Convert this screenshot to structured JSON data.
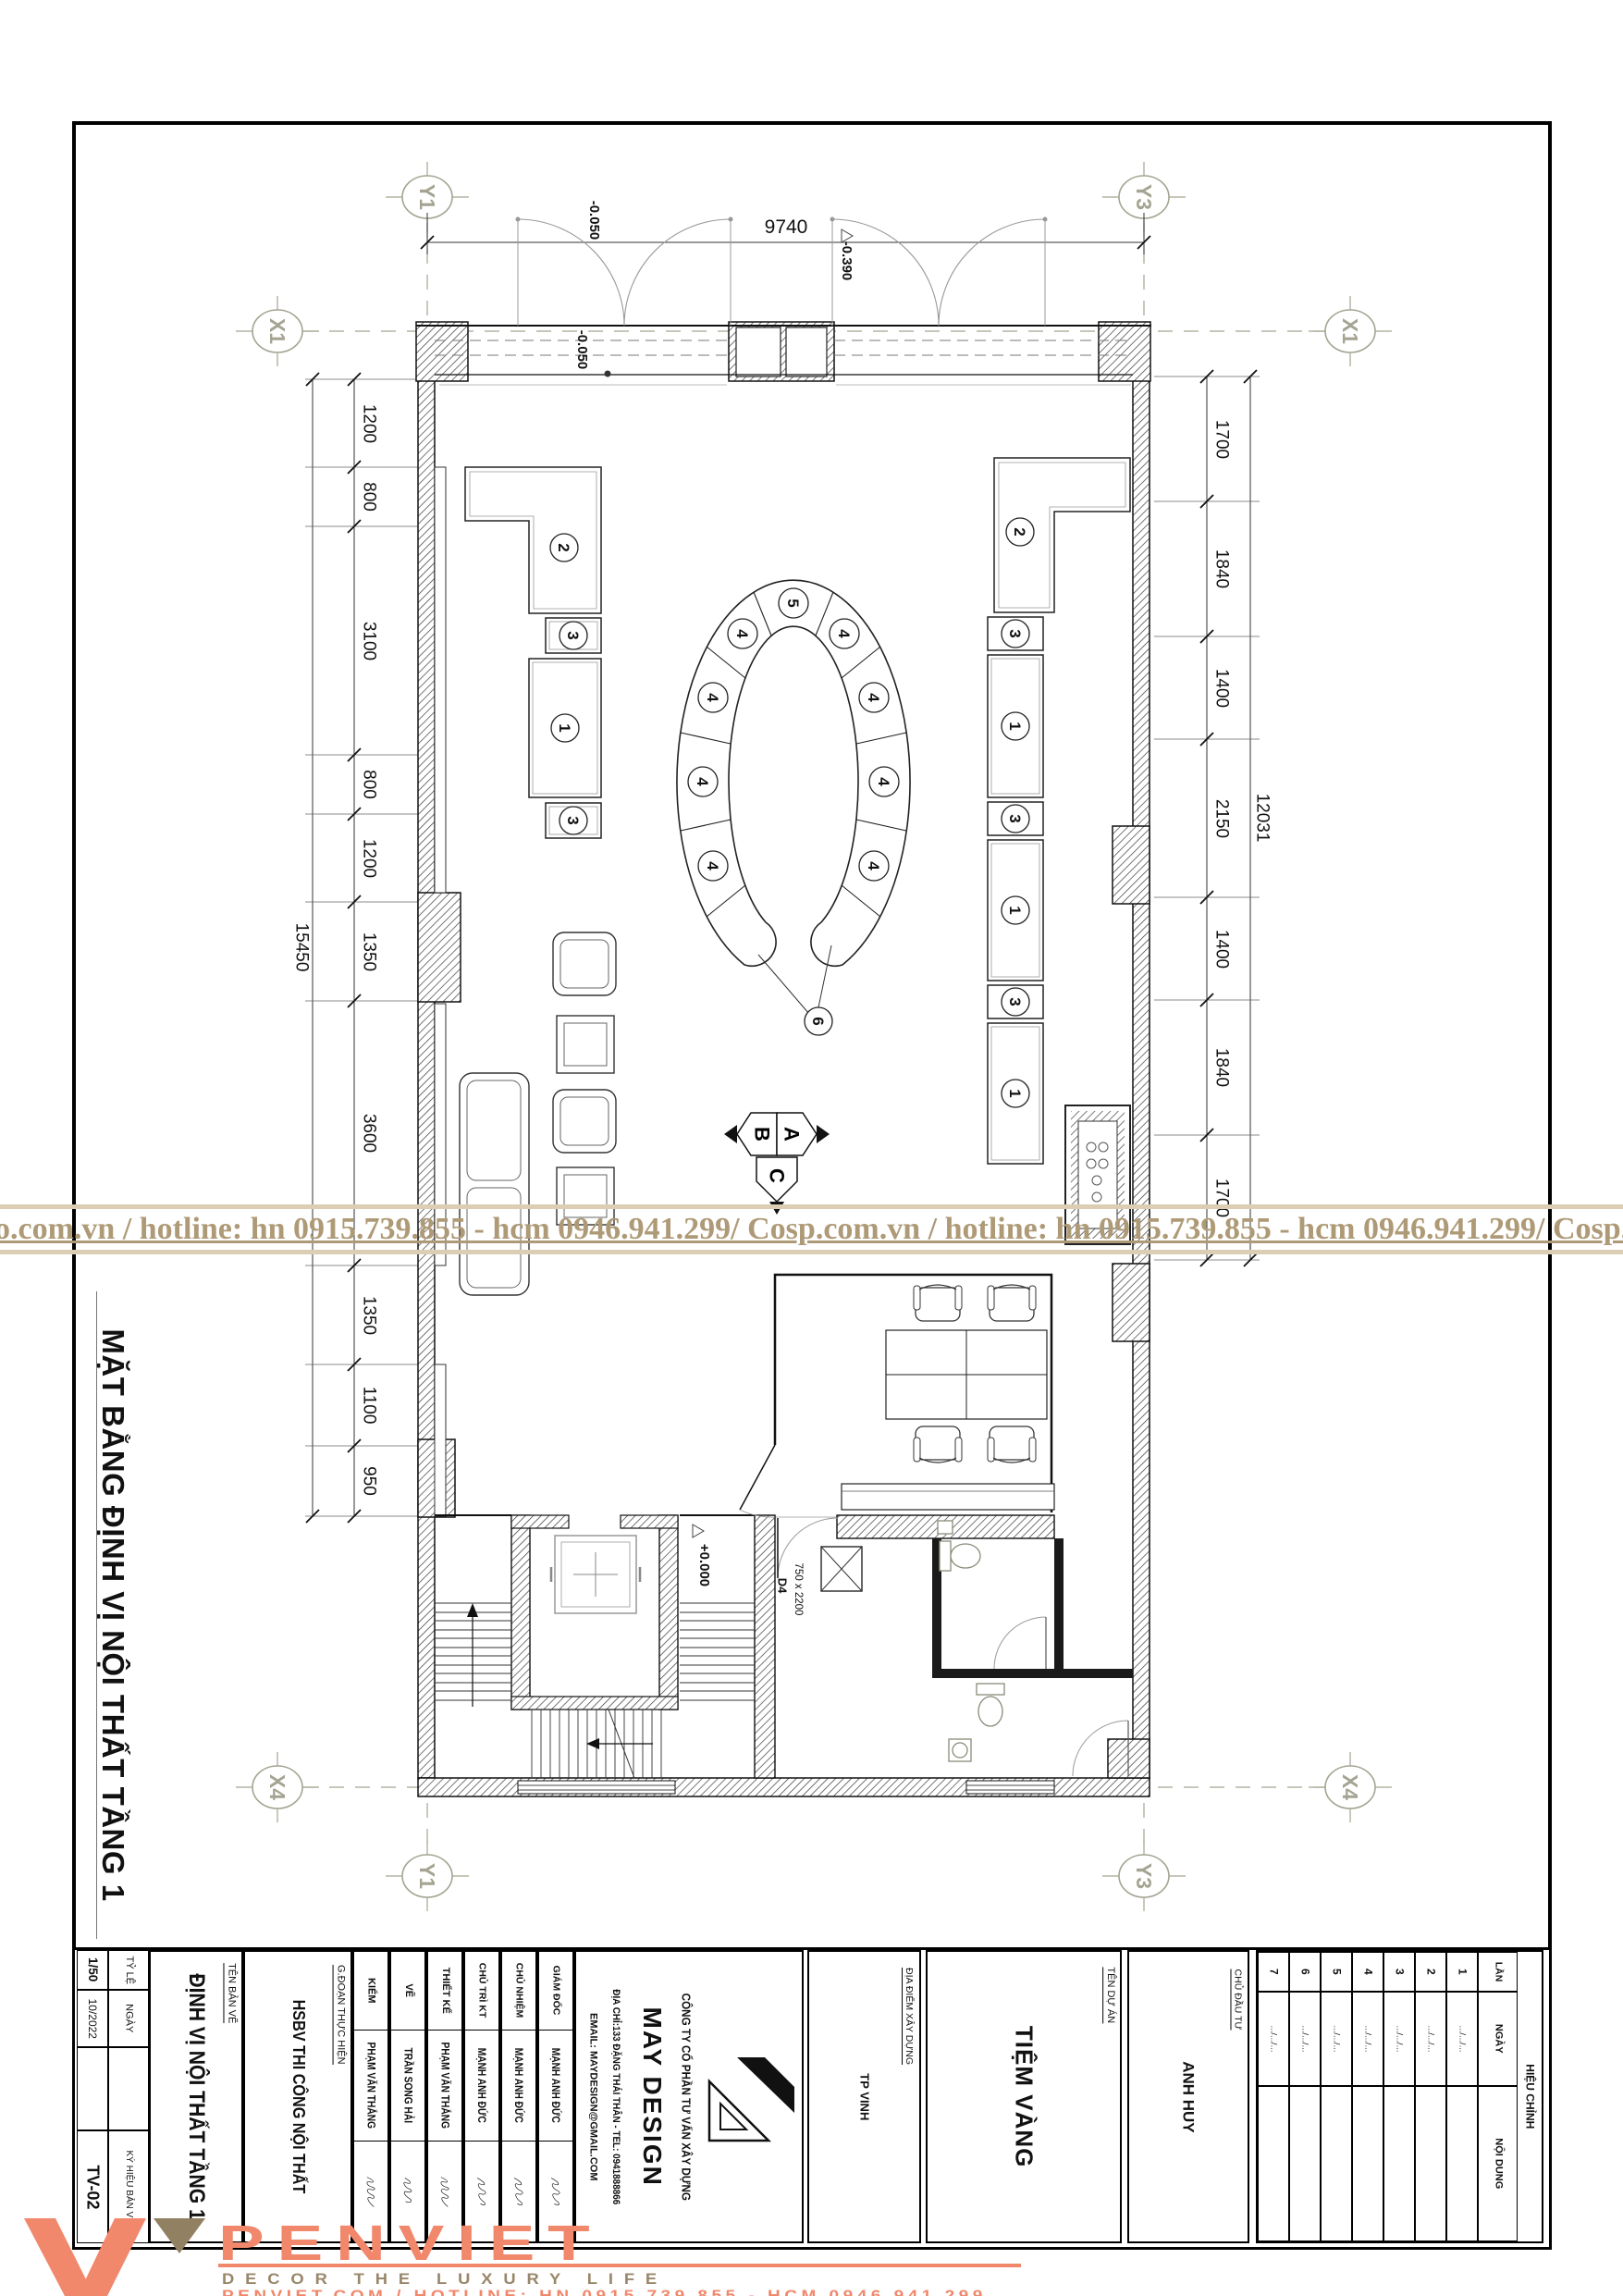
{
  "sheet": {
    "title_vertical": "MẶT BẰNG ĐỊNH VỊ NỘI THẤT TẦNG 1"
  },
  "watermark": {
    "text": "o.com.vn / hotline: hn 0915.739.855 - hcm 0946.941.299/  Cosp.com.vn / hotline: hn 0915.739.855 - hcm 0946.941.299/  Cosp.com.vn / hotline: h",
    "color": "#AE9A76"
  },
  "grid": {
    "y1": "Y1",
    "y3": "Y3",
    "x1": "X1",
    "x4": "X4"
  },
  "dims": {
    "top": "9740",
    "left": [
      "1200",
      "800",
      "3100",
      "800",
      "1200",
      "1350",
      "3600",
      "1350",
      "1100",
      "950"
    ],
    "left_total": "15450",
    "right": [
      "1700",
      "1840",
      "1400",
      "2150",
      "1400",
      "1840",
      "1700"
    ],
    "right_total": "12031"
  },
  "levels": {
    "storefront": "-0.050",
    "entry": "-0.390",
    "floor": "+0.000"
  },
  "door": {
    "code": "D4",
    "size": "750 x 2200"
  },
  "callouts": {
    "n1": "1",
    "n2": "2",
    "n3": "3",
    "n4": "4",
    "n5": "5",
    "n6": "6"
  },
  "compass": {
    "a": "A",
    "b": "B",
    "c": "C"
  },
  "title_block": {
    "scale_label": "TỶ LỆ",
    "scale": "1/50",
    "date_label": "NGÀY",
    "date": "10/2022",
    "code_label": "KÝ HIỆU BẢN VẼ",
    "code": "TV-02",
    "drawing_name_label": "TÊN BẢN VẼ",
    "drawing_name": "ĐỊNH VỊ NỘI THẤT TẦNG 1",
    "phase_label": "G.ĐOẠN THỰC HIỆN",
    "phase": "HSBV THI CÔNG NỘI THẤT",
    "staff": [
      {
        "role": "KIỂM",
        "name": "PHẠM VĂN THẮNG"
      },
      {
        "role": "VẼ",
        "name": "TRẦN SONG HẢI"
      },
      {
        "role": "THIẾT KẾ",
        "name": "PHẠM VĂN THẮNG"
      },
      {
        "role": "CHỦ TRÌ KT",
        "name": "MẠNH ANH ĐỨC"
      },
      {
        "role": "CHỦ NHIỆM",
        "name": "MẠNH ANH ĐỨC"
      },
      {
        "role": "GIÁM ĐỐC",
        "name": "MẠNH ANH ĐỨC"
      }
    ],
    "company": {
      "type": "CÔNG TY CỔ PHẦN TƯ VẤN XÂY DỰNG",
      "name": "MAY DESIGN",
      "address": "ĐỊA CHỈ:133 ĐẶNG THÁI THÂN - TEL: 0941888866",
      "email": "EMAIL: MAYDESIGN@GMAIL.COM"
    },
    "site_label": "ĐỊA ĐIỂM XÂY DỰNG",
    "site": "TP VINH",
    "project_label": "TÊN DỰ ÁN",
    "project": "TIỆM VÀNG",
    "client_label": "CHỦ ĐẦU TƯ",
    "client": "ANH HUY",
    "revision": {
      "title": "HIỆU CHỈNH",
      "col_no": "LẦN",
      "col_date": "NGÀY",
      "col_content": "NỘI DUNG",
      "rows": [
        [
          "1",
          ".../.../..."
        ],
        [
          "2",
          ".../.../..."
        ],
        [
          "3",
          ".../.../..."
        ],
        [
          "4",
          ".../.../..."
        ],
        [
          "5",
          ".../.../..."
        ],
        [
          "6",
          ".../.../..."
        ],
        [
          "7",
          ".../.../..."
        ]
      ]
    }
  },
  "footer": {
    "brand": "PENVIET",
    "tagline": "DECOR THE LUXURY LIFE",
    "contact": "PENVIET.COM / HOTLINE: HN 0915.739.855 - HCM 0946.941.299",
    "orange": "#F1876B",
    "brown": "#928062"
  }
}
